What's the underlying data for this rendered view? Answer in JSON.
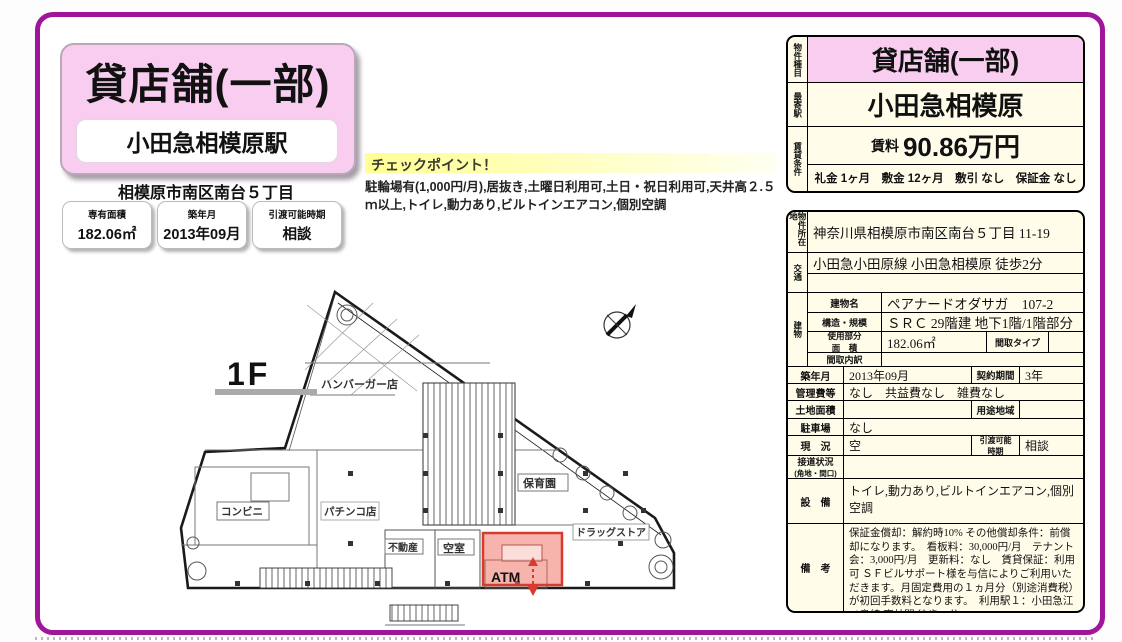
{
  "frame": {
    "border_color": "#a0169a"
  },
  "left_panel": {
    "title": "貸店舗(一部)",
    "station": "小田急相模原駅",
    "address": "相模原市南区南台５丁目",
    "stats": [
      {
        "label": "専有面積",
        "value": "182.06㎡"
      },
      {
        "label": "築年月",
        "value": "2013年09月"
      },
      {
        "label": "引渡可能時期",
        "value": "相談"
      }
    ]
  },
  "checkpoint": {
    "title": "チェックポイント！",
    "body": "駐輪場有(1,000円/月),居抜き,土曜日利用可,土日・祝日利用可,天井高２.５ｍ以上,トイレ,動力あり,ビルトインエアコン,個別空調"
  },
  "floorplan": {
    "floor_label": "1F",
    "highlight_color": "#d83a2c",
    "rooms": [
      {
        "name": "hamburger-shop",
        "label": "ハンバーガー店"
      },
      {
        "name": "convenience-store",
        "label": "コンビニ"
      },
      {
        "name": "pachinko-parlor",
        "label": "パチンコ店"
      },
      {
        "name": "real-estate-office",
        "label": "不動産"
      },
      {
        "name": "vacant-room",
        "label": "空室"
      },
      {
        "name": "atm",
        "label": "ATM"
      },
      {
        "name": "nursery-school",
        "label": "保育園"
      },
      {
        "name": "drug-store",
        "label": "ドラッグストア"
      }
    ]
  },
  "summary_table": {
    "type_label": "物件種目",
    "type_value": "貸店舗(一部)",
    "station_label": "最寄駅",
    "station_value": "小田急相模原",
    "terms_label": "賃貸条件",
    "rent_label": "賃料",
    "rent_value": "90.86万円",
    "fees": "礼金 1ヶ月　敷金 12ヶ月　敷引 なし　保証金 なし"
  },
  "detail_table": {
    "location_label": "物件所在地",
    "location": "神奈川県相模原市南区南台５丁目 11-19",
    "access_label": "交通",
    "access_line1": "小田急小田原線 小田急相模原 徒歩2分",
    "access_line2": "",
    "building_label": "建物",
    "building_name_label": "建物名",
    "building_name": "ペアナードオダサガ　107-2",
    "structure_label": "構造・規模",
    "structure": "ＳＲＣ 29階建 地下1階/1階部分",
    "used_area_label_1": "使用部分",
    "used_area_label_2": "面　積",
    "used_area": "182.06㎡",
    "layout_type_label": "間取タイプ",
    "layout_type": "",
    "layout_detail_label": "間取内訳",
    "layout_detail": "",
    "built_label": "築年月",
    "built": "2013年09月",
    "contract_label": "契約期間",
    "contract": "3年",
    "management_label": "管理費等",
    "management": "なし　共益費なし　雑費なし",
    "land_area_label": "土地面積",
    "land_area": "",
    "zoning_label": "用途地域",
    "zoning": "",
    "parking_label": "駐車場",
    "parking": "なし",
    "status_label": "現　況",
    "status": "空",
    "handover_label_1": "引渡可能",
    "handover_label_2": "時期",
    "handover": "相談",
    "road_label_1": "接道状況",
    "road_label_2": "(角地・間口)",
    "road": "",
    "equipment_label": "設　備",
    "equipment": "トイレ,動力あり,ビルトインエアコン,個別空調",
    "remarks_label": "備　考",
    "remarks": "保証金償却：解約時10% その他償却条件：前償却になります。　看板料：30,000円/月　テナント会：3,000円/月　更新料：なし　賃貸保証：利用可 ＳＦビルサポート様を与信によりご利用いただきます。月固定費用の１ヵ月分（別途消費税）が初回手数料となります。　利用駅１：小田急江ノ島線 東林間 徒歩25分"
  }
}
